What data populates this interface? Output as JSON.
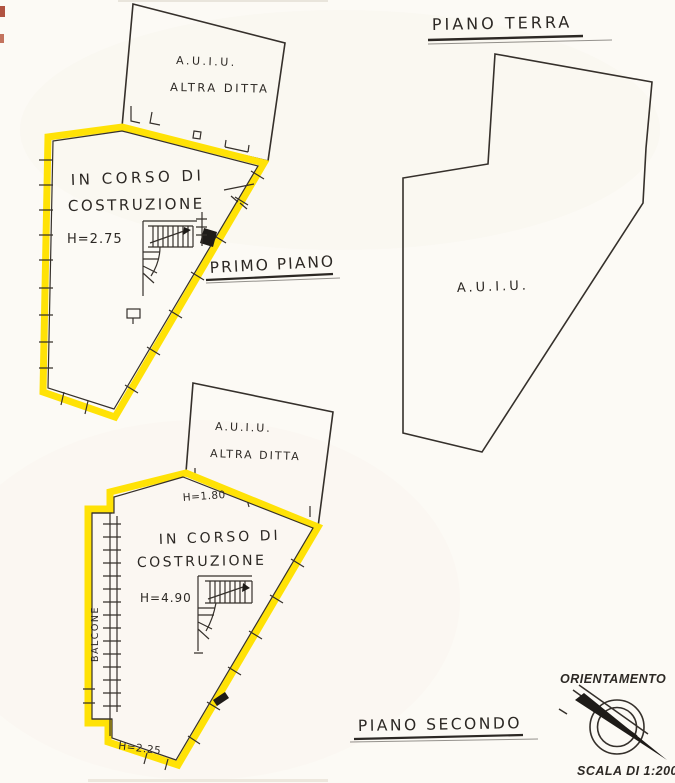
{
  "titles": {
    "piano_terra": "PIANO TERRA",
    "primo_piano": "PRIMO PIANO",
    "piano_secondo": "PIANO SECONDO"
  },
  "plans": {
    "primo_piano": {
      "neighbor": {
        "line1": "A.U.I.U.",
        "line2": "ALTRA DITTA"
      },
      "status": {
        "line1": "IN CORSO DI",
        "line2": "COSTRUZIONE"
      },
      "height": "H=2.75"
    },
    "piano_terra": {
      "unit": "A.U.I.U."
    },
    "piano_secondo": {
      "neighbor": {
        "line1": "A.U.I.U.",
        "line2": "ALTRA DITTA"
      },
      "height_top": "H=1.80",
      "status": {
        "line1": "IN CORSO DI",
        "line2": "COSTRUZIONE"
      },
      "height_main": "H=4.90",
      "balcony_label": "BALCONE",
      "height_bottom": "H=2.25"
    }
  },
  "legend": {
    "orientation": "ORIENTAMENTO",
    "scale": "SCALA DI 1:200"
  },
  "colors": {
    "highlight_yellow": "#FFE206",
    "ink": "#35302b",
    "paper": "#fcfaf5"
  }
}
